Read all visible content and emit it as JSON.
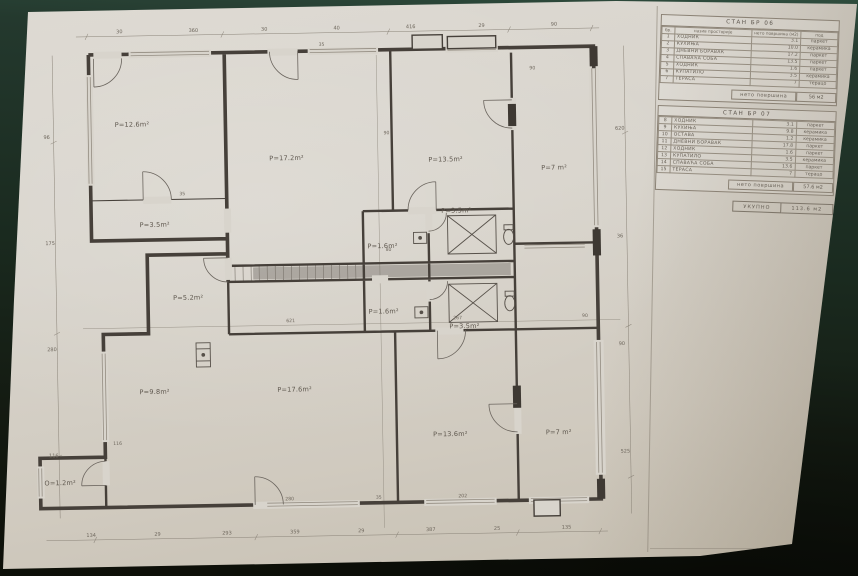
{
  "photo": {
    "background_top": "#2e4c3d",
    "background_bottom": "#0d0f08",
    "paper_color": "#d8d4cc",
    "line_color": "#4a443c"
  },
  "legend": {
    "apartments": [
      {
        "title": "СТАН БР 06",
        "columns": [
          "бр.",
          "назив просторије",
          "нето површина (м2)",
          "под"
        ],
        "rows": [
          [
            "1",
            "ХОДНИК",
            "3.1",
            "паркет"
          ],
          [
            "2",
            "КУХИЊА",
            "10.0",
            "керамика"
          ],
          [
            "3",
            "ДНЕВНИ БОРАВАК",
            "17.2",
            "паркет"
          ],
          [
            "4",
            "СПАВАЋА СОБА",
            "13.5",
            "паркет"
          ],
          [
            "5",
            "ХОДНИК",
            "1.6",
            "паркет"
          ],
          [
            "6",
            "КУПАТИЛО",
            "3.5",
            "керамика"
          ],
          [
            "7",
            "ТЕРАСА",
            "7",
            "терацо"
          ]
        ],
        "subtotal_label": "нето површина",
        "subtotal_value": "56 м2"
      },
      {
        "title": "СТАН БР 07",
        "columns": [
          "бр.",
          "назив просторије",
          "нето површина (м2)",
          "под"
        ],
        "rows": [
          [
            "8",
            "ХОДНИК",
            "3.1",
            "паркет"
          ],
          [
            "9",
            "КУХИЊА",
            "9.8",
            "керамика"
          ],
          [
            "10",
            "ОСТАВА",
            "1.2",
            "керамика"
          ],
          [
            "11",
            "ДНЕВНИ БОРАВАК",
            "17.8",
            "паркет"
          ],
          [
            "12",
            "ХОДНИК",
            "1.6",
            "паркет"
          ],
          [
            "13",
            "КУПАТИЛО",
            "3.5",
            "керамика"
          ],
          [
            "14",
            "СПАВАЋА СОБА",
            "13.6",
            "паркет"
          ],
          [
            "15",
            "ТЕРАСА",
            "7",
            "терацо"
          ]
        ],
        "subtotal_label": "нето површина",
        "subtotal_value": "57.6 м2"
      }
    ],
    "total_label": "УКУПНО",
    "total_value": "113.6 м2"
  },
  "plan": {
    "rooms": [
      {
        "id": "room-top-left",
        "label": "P=12.6m²"
      },
      {
        "id": "room-top-left-hall",
        "label": "P=3.5m²"
      },
      {
        "id": "living-room-06",
        "label": "P=17.2m²"
      },
      {
        "id": "bedroom-06",
        "label": "P=13.5m²"
      },
      {
        "id": "terrace-06",
        "label": "P=7 m²"
      },
      {
        "id": "hall-06",
        "label": "P=1.6m²"
      },
      {
        "id": "bathroom-06",
        "label": "P=3.5m²"
      },
      {
        "id": "hall-07",
        "label": "P=1.6m²"
      },
      {
        "id": "bathroom-07",
        "label": "P=3.5m²"
      },
      {
        "id": "room-mid-left",
        "label": "P=5.2m²"
      },
      {
        "id": "kitchen-07",
        "label": "P=9.8m²"
      },
      {
        "id": "storage-07",
        "label": "O=1.2m²"
      },
      {
        "id": "living-room-07",
        "label": "P=17.6m²"
      },
      {
        "id": "bedroom-07",
        "label": "P=13.6m²"
      },
      {
        "id": "terrace-07",
        "label": "P=7 m²"
      }
    ],
    "dims": {
      "top": [
        "30",
        "360",
        "30",
        "40",
        "416",
        "29",
        "90"
      ],
      "bottom": [
        "134",
        "29",
        "293",
        "359",
        "29",
        "387",
        "25",
        "135"
      ],
      "left": [
        "96",
        "175",
        "280",
        "116"
      ],
      "right": [
        "620",
        "36",
        "90",
        "525"
      ]
    },
    "wall_tags": [
      {
        "t": "621",
        "x": 262,
        "y": 309
      },
      {
        "t": "267",
        "x": 428,
        "y": 309
      },
      {
        "t": "90",
        "x": 556,
        "y": 309
      },
      {
        "t": "35",
        "x": 299,
        "y": 35
      },
      {
        "t": "90",
        "x": 362,
        "y": 124
      },
      {
        "t": "80",
        "x": 362,
        "y": 240
      },
      {
        "t": "35",
        "x": 158,
        "y": 181
      },
      {
        "t": "90",
        "x": 508,
        "y": 62
      },
      {
        "t": "280",
        "x": 258,
        "y": 486
      },
      {
        "t": "202",
        "x": 430,
        "y": 486
      },
      {
        "t": "35",
        "x": 348,
        "y": 486
      },
      {
        "t": "116",
        "x": 88,
        "y": 428
      }
    ]
  }
}
